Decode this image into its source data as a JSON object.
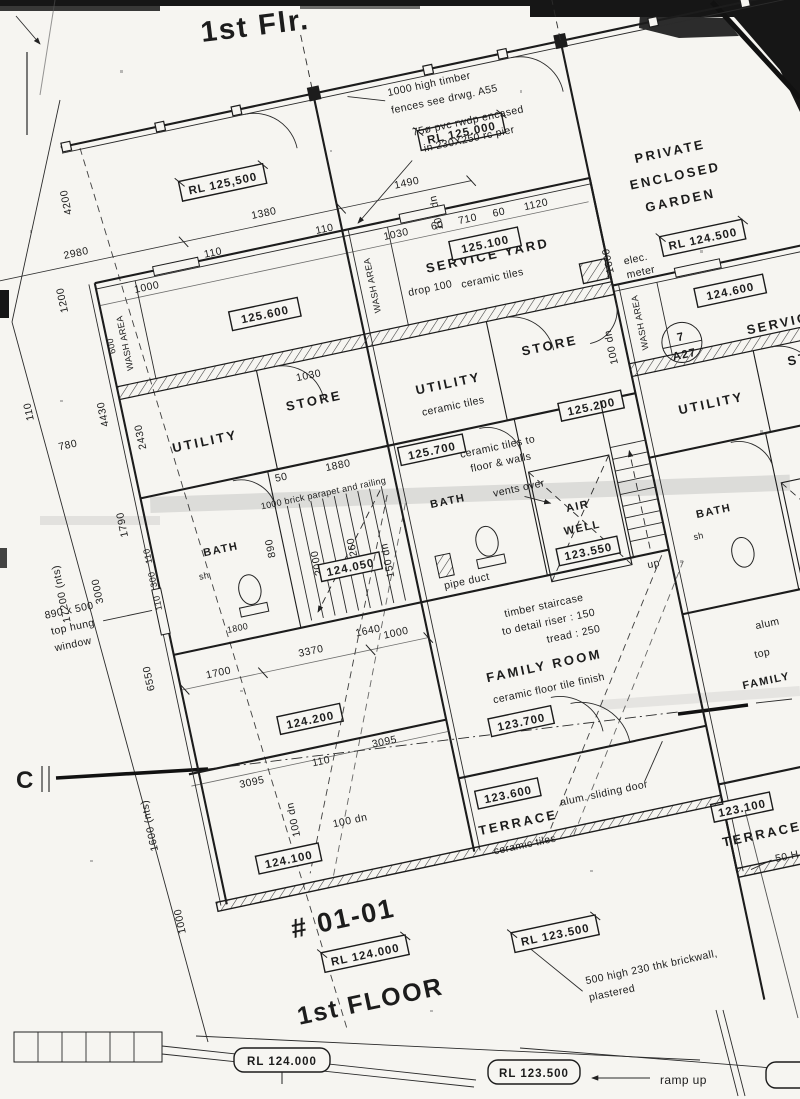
{
  "hw": {
    "top": "1st Flr.",
    "unit": "# 01-01",
    "floor": "1st FLOOR"
  },
  "garden": {
    "rl_u1": "RL 125,500",
    "rl_u2": "RL 125.000",
    "rl_u3": "RL 124.500",
    "private": [
      "PRIVATE",
      "ENCLOSED",
      "GARDEN"
    ],
    "fence_note": [
      "1000 high timber",
      "fences see drwg. A55"
    ],
    "rwdp_note": [
      "75ø pvc rwdp encased",
      "in 230X250 rc pier"
    ]
  },
  "rooms": {
    "wash": "WASH AREA",
    "service_yard": "SERVICE   YARD",
    "service": "SERVICE",
    "yard_cut": "Y",
    "ceramic": "ceramic tiles",
    "store": "STORE",
    "utility": "UTILITY",
    "bath": "BATH",
    "air": "AIR",
    "well": "WELL",
    "family": "FAMILY   ROOM",
    "family_cut": "FAMILY",
    "family_finish": "ceramic floor tile finish",
    "terrace": "TERRACE",
    "sh": "sh"
  },
  "levels": {
    "b125600": "125.600",
    "b125100": "125.100",
    "b124600": "124.600",
    "b125200": "125.200",
    "b125700": "125.700",
    "b123550": "123.550",
    "b124050": "124.050",
    "b1230": "123.0",
    "b124200": "124.200",
    "b123700": "123.700",
    "b123600": "123.600",
    "b123100": "123.100",
    "b124100": "124.100",
    "rl124000": "RL 124.000",
    "rl123500": "RL 123.500"
  },
  "notes": {
    "drop": "drop 100",
    "elec": [
      "elec.",
      "meter"
    ],
    "tiles": [
      "ceramic tiles to",
      "floor & walls"
    ],
    "parapet": "1000 brick parapet and railing",
    "window": [
      "890 x 500",
      "top hung",
      "window"
    ],
    "vents": "vents over",
    "pipe": "pipe duct",
    "up": "up",
    "stair": [
      "timber staircase",
      "to detail riser : 150",
      "tread : 250"
    ],
    "sliding": "alum. sliding door",
    "alum_cut": "alum",
    "top_cut": "top",
    "fifty_cut": "50 H",
    "brick": [
      "500 high 230 thk brickwall,",
      "plastered"
    ],
    "ramp": "ramp up",
    "c": "C",
    "a27": "A27",
    "a27_num": "7"
  },
  "dims": {
    "d2980": "2980",
    "d1380": "1380",
    "d1490": "1490",
    "d110": "110",
    "d100dn": "100 dn",
    "d1000": "1000",
    "d1030": "1030",
    "d60": "60",
    "d710": "710",
    "d1120": "1120",
    "d1600": "1600",
    "d600": "600",
    "d2000": "2000",
    "d2430": "2430",
    "d1880": "1880",
    "d50": "50",
    "d890": "890",
    "d2260": "2260",
    "d1640": "1640",
    "d150dn": "150 dn",
    "d1800": "1800",
    "d1700": "1700",
    "d3370": "3370",
    "d3095": "3095",
    "d1600nts": "1600 (nts)",
    "d17200": "17200 (nts)",
    "d3000": "3000",
    "d1790": "1790",
    "d300": "300",
    "d6550": "6550",
    "d4200": "4200",
    "d1200": "1200",
    "d4430": "4430",
    "d780": "780"
  }
}
